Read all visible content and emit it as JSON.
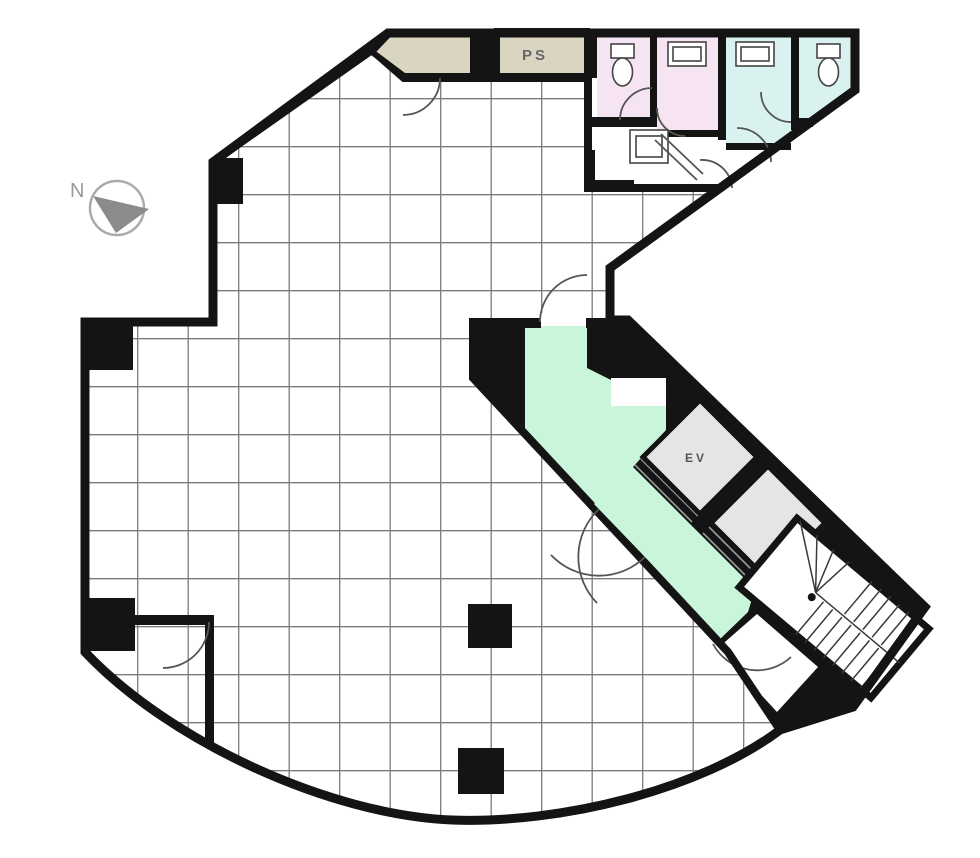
{
  "title": "Office building floor plan",
  "labels": {
    "ps": "PS",
    "ev": "EV",
    "north": "N"
  },
  "colors": {
    "wall": "#141414",
    "floor": "#ffffff",
    "beige": "#d9d5c1",
    "pink": "#f7e4f2",
    "cyan": "#daf2ef",
    "mint": "#c9f6da",
    "shaft_gray": "#e6e5e3",
    "grid": "#5a5a5a",
    "fixture": "#444444",
    "arc": "#555555",
    "north": "#8b8b8b",
    "label": "#666666"
  }
}
